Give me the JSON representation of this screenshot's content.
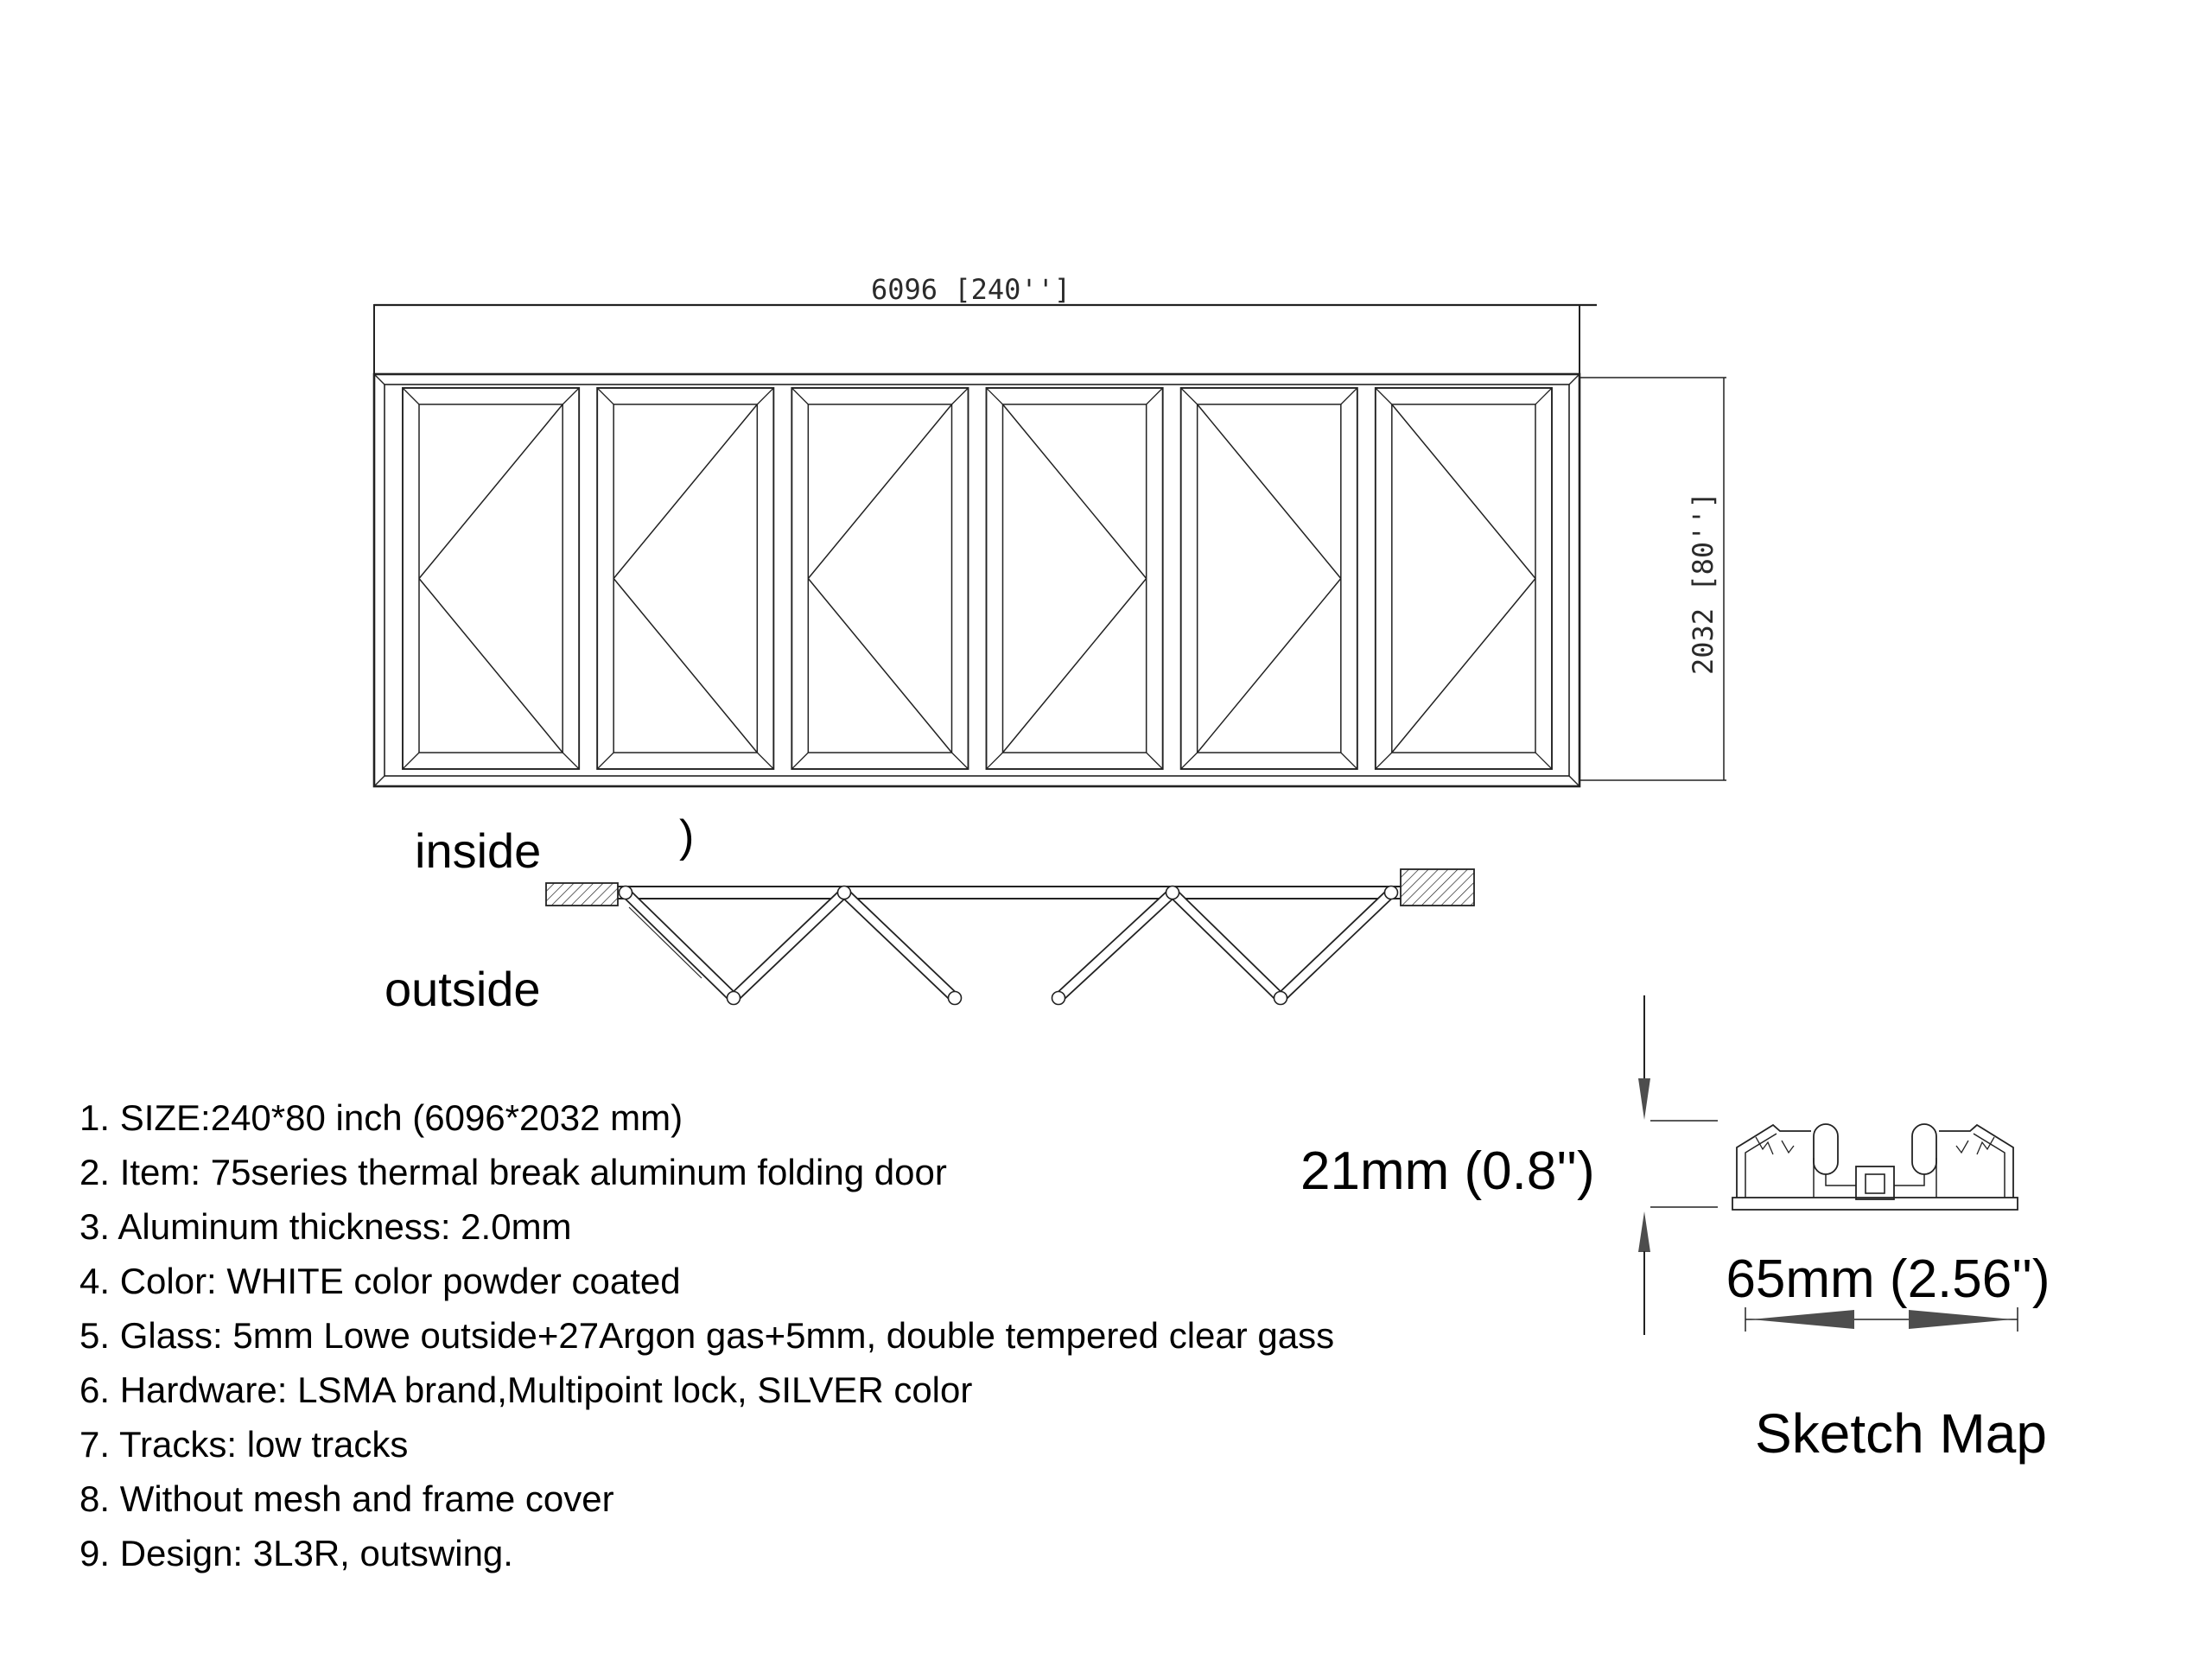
{
  "elevation": {
    "width_dimension_label": "6096 [240'']",
    "height_dimension_label": "2032 [80'']"
  },
  "plan": {
    "inside_label": "inside",
    "outside_label": "outside",
    "brace_mark": ")"
  },
  "specs": {
    "items": [
      "1. SIZE:240*80 inch (6096*2032 mm)",
      "2. Item: 75series thermal break aluminum folding door",
      "3. Aluminum thickness: 2.0mm",
      "4. Color: WHITE color powder coated",
      "5. Glass: 5mm Lowe outside+27Argon gas+5mm, double tempered clear gass",
      "6. Hardware: LSMA brand,Multipoint lock, SILVER color",
      "7. Tracks: low tracks",
      "8. Without mesh and frame cover",
      "9. Design: 3L3R, outswing."
    ]
  },
  "profile": {
    "height_label": "21mm (0.8'')",
    "width_label": "65mm (2.56'')",
    "caption": "Sketch Map"
  },
  "drawing": {
    "panel_count": 6,
    "panel_directions": [
      "L",
      "L",
      "L",
      "R",
      "R",
      "R"
    ],
    "colors": {
      "line": "#222222",
      "arrow": "#4d4d4d",
      "background": "#ffffff"
    }
  }
}
